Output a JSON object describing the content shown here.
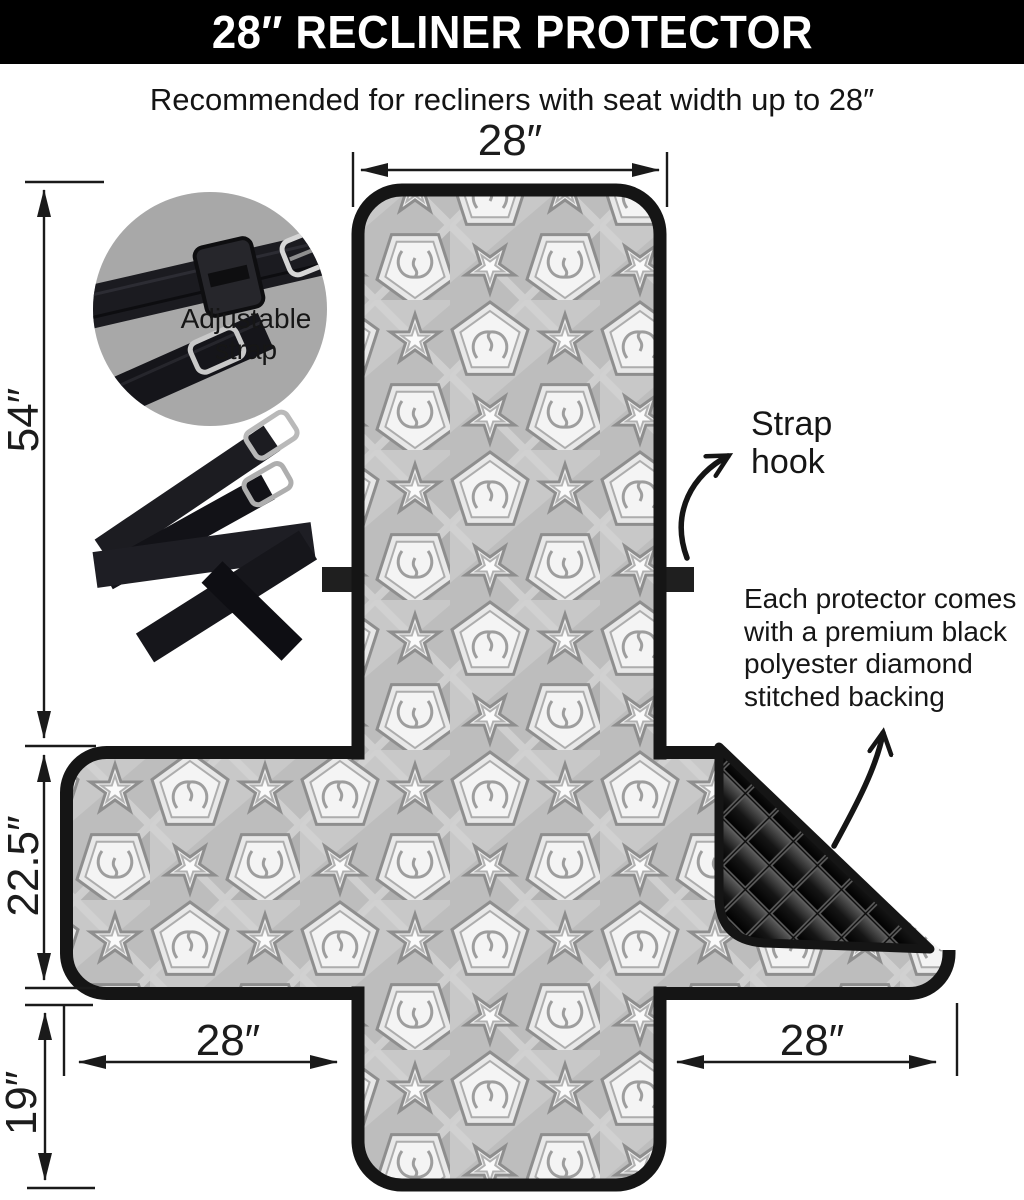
{
  "header": {
    "title": "28″ RECLINER PROTECTOR"
  },
  "subtitle": "Recommended for recliners with seat width up to 28″",
  "dimensions": {
    "top_width": "28″",
    "side_height": "54″",
    "wing_height": "22.5″",
    "front_flap_height": "19″",
    "left_wing_width": "28″",
    "right_wing_width": "28″"
  },
  "callouts": {
    "adjustable_strap_lines": [
      "Adjustable",
      "strap"
    ],
    "strap_hook_lines": [
      "Strap",
      "hook"
    ],
    "backing_note_lines": [
      "Each protector comes",
      "with a premium black",
      "polyester diamond",
      "stitched backing"
    ]
  },
  "colors": {
    "header_bg": "#000000",
    "header_text": "#ffffff",
    "body_text": "#1c1c1c",
    "binding_black": "#151515",
    "inset_circle_gray": "#a8a8a8",
    "quilt_black": "#0d0d0d",
    "pattern_base_gray": "#bdbdbd"
  }
}
